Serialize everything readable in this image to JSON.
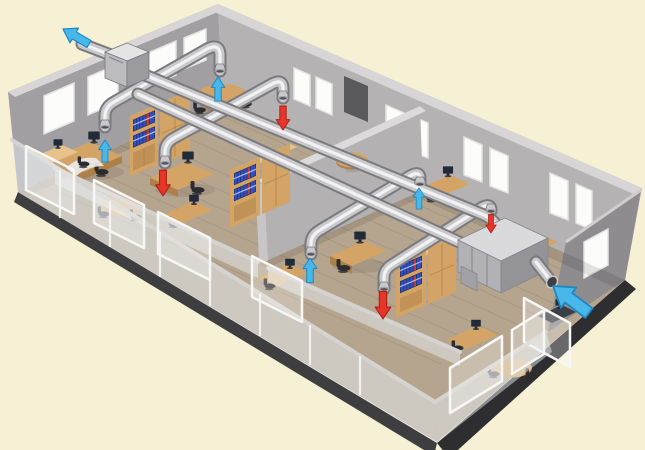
{
  "colors": {
    "background": "#f6f1d4",
    "slab_front": "#3e3e41",
    "slab_right": "#2e2e31",
    "floor": "#b5a58f",
    "floor_line": "#8f8171",
    "wall_left": "#a19fa1",
    "wall_right": "#b4b2b3",
    "wall_end": "#8e8c8e",
    "wall_cap": "#d7d5d6",
    "partition": "#b3b1b2",
    "partition_cap": "#dcdadb",
    "doorway": "#59585a",
    "window": "#fcfcfa",
    "window_frame": "#e4e4e2",
    "glass": "#e8eef1",
    "glass_frame": "#f7f7f5",
    "rail": "#d5d3cf",
    "duct_dark": "#7a7a7e",
    "duct_mid": "#c9c9cc",
    "duct_hi": "#f4f4f6",
    "vent_rim": "#a3a3a7",
    "vent_dark": "#515155",
    "box_top": "#e4e4e6",
    "box_left": "#bcbcbf",
    "box_right": "#9b9b9f",
    "ahu_top": "#dadadd",
    "ahu_front": "#b2b2b6",
    "ahu_side": "#949498",
    "ahu_seam": "#84848a",
    "wood": "#d3a465",
    "wood_dark": "#ad7f49",
    "wood_light": "#e7c28b",
    "white_desk": "#eaeced",
    "monitor": "#222a38",
    "chair": "#2c2c30",
    "binder_blue": "#3050c3",
    "binder_red": "#c03b31",
    "supply_blue": "#47b8e9",
    "supply_blue_edge": "#1f88bf",
    "extract_red": "#e73529",
    "extract_red_edge": "#aa2017",
    "shadow": "#55504a"
  },
  "scene": {
    "airflow_arrows": [
      {
        "name": "exhaust-outlet-arrow",
        "kind": "exhaust-air-to-outside",
        "color": "supply_blue",
        "edge": "supply_blue_edge",
        "tip": [
          63,
          29
        ],
        "rotate": -60,
        "scale": 1.0
      },
      {
        "name": "supply-diffuser-arrow-left-back",
        "kind": "supply-air",
        "color": "supply_blue",
        "edge": "supply_blue_edge",
        "tip": [
          218,
          77
        ],
        "rotate": 0,
        "scale": 0.8
      },
      {
        "name": "extract-grille-arrow-left-back",
        "kind": "extract-air",
        "color": "extract_red",
        "edge": "extract_red_edge",
        "tip": [
          283,
          130
        ],
        "rotate": 180,
        "scale": 0.8
      },
      {
        "name": "supply-diffuser-arrow-left-front",
        "kind": "supply-air",
        "color": "supply_blue",
        "edge": "supply_blue_edge",
        "tip": [
          105,
          140
        ],
        "rotate": 0,
        "scale": 0.74
      },
      {
        "name": "extract-grille-arrow-left-mid",
        "kind": "extract-air",
        "color": "extract_red",
        "edge": "extract_red_edge",
        "tip": [
          163,
          196
        ],
        "rotate": 180,
        "scale": 0.86
      },
      {
        "name": "supply-diffuser-arrow-right-front",
        "kind": "supply-air",
        "color": "supply_blue",
        "edge": "supply_blue_edge",
        "tip": [
          310,
          258
        ],
        "rotate": 0,
        "scale": 0.82
      },
      {
        "name": "extract-grille-arrow-right-front",
        "kind": "extract-air",
        "color": "extract_red",
        "edge": "extract_red_edge",
        "tip": [
          383,
          319
        ],
        "rotate": 180,
        "scale": 0.92
      },
      {
        "name": "supply-diffuser-arrow-right-back",
        "kind": "supply-air",
        "color": "supply_blue",
        "edge": "supply_blue_edge",
        "tip": [
          419,
          188
        ],
        "rotate": 0,
        "scale": 0.7
      },
      {
        "name": "extract-grille-arrow-ahu",
        "kind": "extract-air",
        "color": "extract_red",
        "edge": "extract_red_edge",
        "tip": [
          491,
          233
        ],
        "rotate": 180,
        "scale": 0.62
      },
      {
        "name": "fresh-air-intake-arrow",
        "kind": "fresh-air-from-outside",
        "color": "supply_blue",
        "edge": "supply_blue_edge",
        "tip": [
          553,
          286
        ],
        "rotate": -53,
        "scale": 1.5
      }
    ]
  }
}
